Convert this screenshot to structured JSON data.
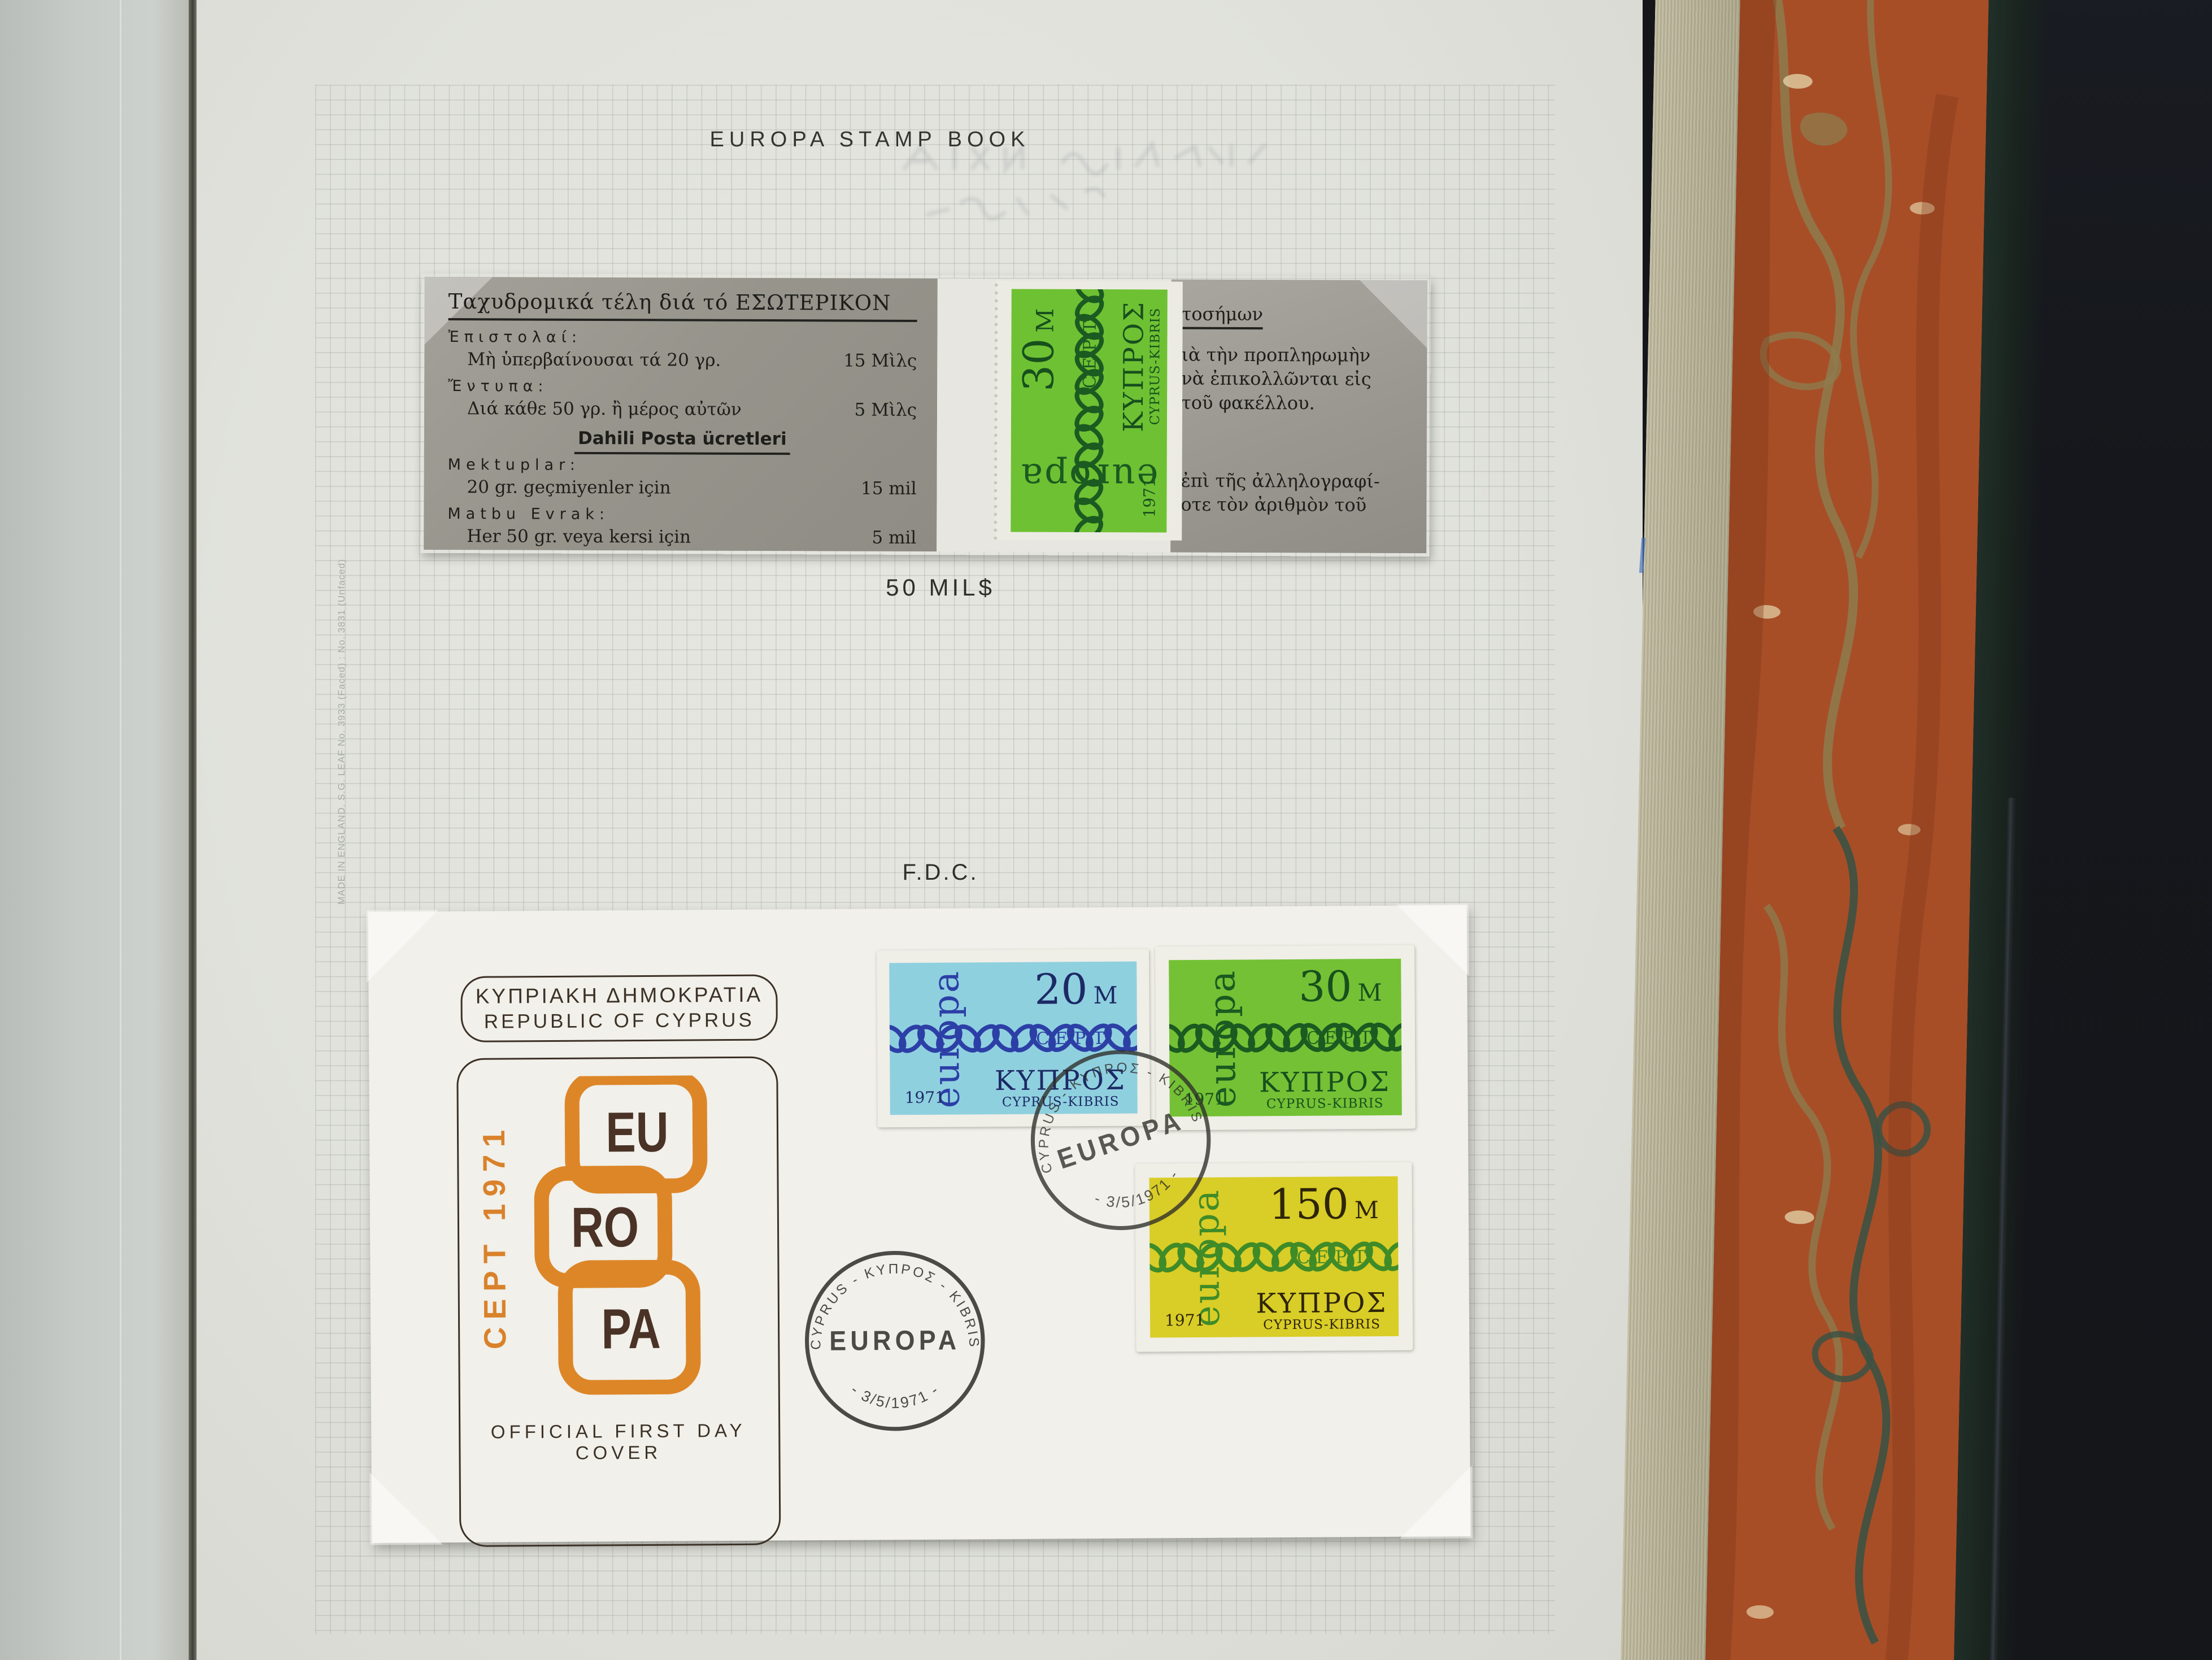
{
  "page": {
    "title": "EUROPA STAMP BOOK",
    "margin_note": "MADE IN ENGLAND.  S.G. LEAF No. 3933 (Faced) : No. 3831 (Unfaced)",
    "booklet_caption": "50 MIL$",
    "fdc_caption": "F.D.C."
  },
  "booklet": {
    "greek_title": "Ταχυδρομικά τέλη διά τό ΕΣΩΤΕΡΙΚΟΝ",
    "greek_h1": "Ἐπιστολαί:",
    "greek_rows": [
      {
        "label": "Μὴ ὑπερβαίνουσαι τά 20 γρ.",
        "value": "15 Μὶλς"
      },
      {
        "label": "Διά κάθε 50 γρ. ἢ μέρος αὐτῶν",
        "value": "5 Μὶλς"
      }
    ],
    "greek_h2": "Ἔντυπα:",
    "turkish_title": "Dahili Posta ücretleri",
    "turkish_h1": "Mektuplar:",
    "turkish_rows": [
      {
        "label": "20 gr. geçmiyenler için",
        "value": "15    mil"
      },
      {
        "label": "Her 50 gr. veya kersi için",
        "value": "5    mil"
      }
    ],
    "turkish_h2": "Matbu Evrak:",
    "right_panel": [
      "τοσήμων",
      "ιὰ τὴν προπληρωμὴν",
      "νὰ ἐπικολλῶνται εἰς",
      "τοῦ φακέλλου.",
      "ἐπὶ τῆς ἀλληλογραφί-",
      "οτε τὸν ἀριθμὸν τοῦ"
    ]
  },
  "stamp_common": {
    "europa": "europa",
    "cept": "CEPT",
    "country_greek": "ΚΥΠΡΟΣ",
    "country_latin": "CYPRUS-KIBRIS",
    "year": "1971"
  },
  "stamps": {
    "booklet": {
      "value": "30",
      "unit": "M",
      "bg": "#6ec133",
      "chain": "#1b5a20",
      "value_color": "#174f1d",
      "country_color": "#174f1d"
    },
    "blue": {
      "value": "20",
      "unit": "M",
      "bg": "#8fd0df",
      "chain": "#2c3fa6",
      "value_color": "#1c2a66",
      "country_color": "#1c2a66"
    },
    "green": {
      "value": "30",
      "unit": "M",
      "bg": "#74c135",
      "chain": "#1b5a20",
      "value_color": "#174f1d",
      "country_color": "#174f1d"
    },
    "yellow": {
      "value": "150",
      "unit": "M",
      "bg": "#d9cd27",
      "chain": "#3f8b28",
      "value_color": "#2e2509",
      "country_color": "#2e2509"
    }
  },
  "fdc": {
    "header_line1": "ΚΥΠΡΙΑΚΗ ΔΗΜΟΚΡΑΤΙΑ",
    "header_line2": "REPUBLIC OF CYPRUS",
    "cept_vertical": "CEPT 1971",
    "logo_segments": [
      "EU",
      "RO",
      "PA"
    ],
    "footer": "OFFICIAL FIRST DAY COVER",
    "postmark": {
      "arc_top": "CYPRUS - ΚΥΠΡΟΣ - KIBRIS",
      "center": "EUROPA",
      "arc_bottom": "-  3/5/1971  -"
    }
  },
  "colors": {
    "cachet_orange": "#d9822b",
    "cachet_brown": "#4a3226",
    "postmark_ink": "#2e2e2a",
    "marble_rust": "#a74e27",
    "marble_gold": "#8d7c4e",
    "marble_teal": "#3c5244"
  }
}
